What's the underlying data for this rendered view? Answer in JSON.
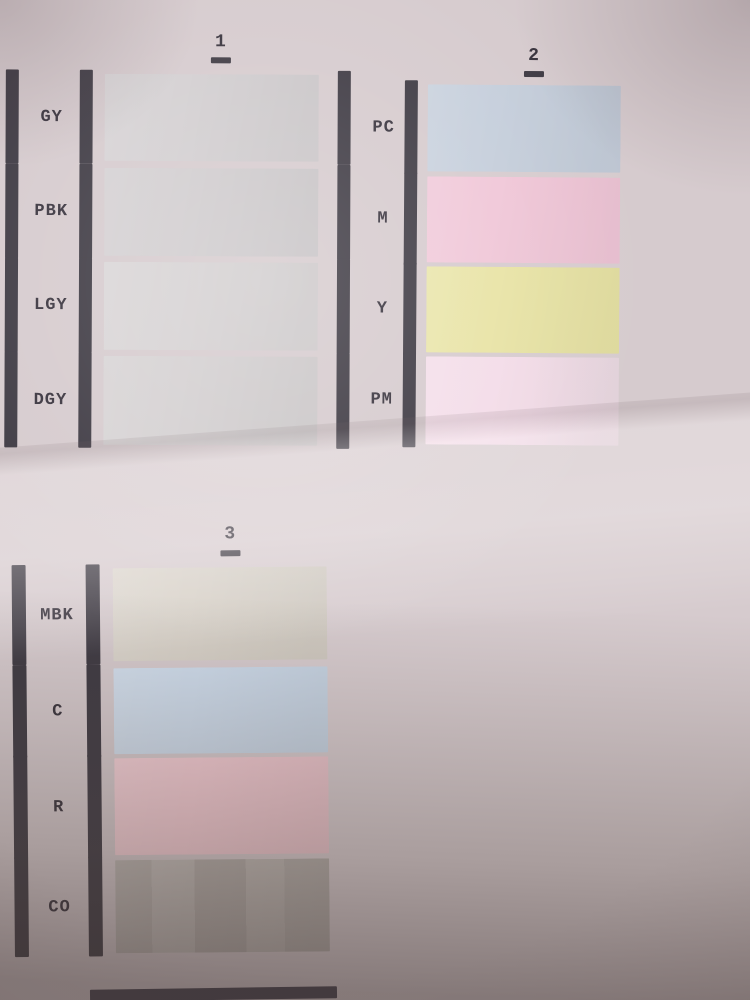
{
  "colors": {
    "paper": "#d6cbce",
    "ink_bar": "#3e3a43",
    "label_text": "#38333d"
  },
  "sections": [
    {
      "number": "1",
      "rows": [
        {
          "label": "GY",
          "swatch": "#d3cfd1"
        },
        {
          "label": "PBK",
          "swatch": "#d1cdcf"
        },
        {
          "label": "LGY",
          "swatch": "#d6d2d3"
        },
        {
          "label": "DGY",
          "swatch": "#d4d0d1"
        }
      ]
    },
    {
      "number": "2",
      "rows": [
        {
          "label": "PC",
          "swatch": "#c5cedb"
        },
        {
          "label": "M",
          "swatch": "#f0c6d7"
        },
        {
          "label": "Y",
          "swatch": "#e8e3a4"
        },
        {
          "label": "PM",
          "swatch": "#f3dce8",
          "fade": true
        }
      ]
    },
    {
      "number": "3",
      "rows": [
        {
          "label": "MBK",
          "swatch": "#d7d1c8"
        },
        {
          "label": "C",
          "swatch": "#cedcec"
        },
        {
          "label": "R",
          "swatch": "#f5cdd5"
        },
        {
          "label": "CO",
          "swatch": "#bfb9b5",
          "banded": true
        }
      ]
    }
  ],
  "bottom_cutoff_bar": {
    "visible": true,
    "color": "#413d4a"
  }
}
